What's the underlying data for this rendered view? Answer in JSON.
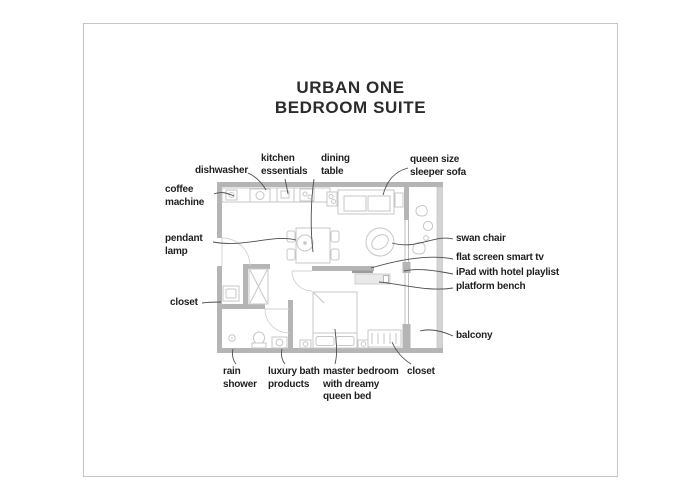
{
  "title": {
    "text": "URBAN ONE\nBEDROOM SUITE"
  },
  "labels": [
    {
      "id": "coffee-machine",
      "text": "coffee\nmachine"
    },
    {
      "id": "dishwasher",
      "text": "dishwasher"
    },
    {
      "id": "kitchen-essentials",
      "text": "kitchen\nessentials"
    },
    {
      "id": "dining-table",
      "text": "dining\ntable"
    },
    {
      "id": "queen-sleeper-sofa",
      "text": "queen size\nsleeper sofa"
    },
    {
      "id": "pendant-lamp",
      "text": "pendant\nlamp"
    },
    {
      "id": "swan-chair",
      "text": "swan chair"
    },
    {
      "id": "flat-screen-smart-tv",
      "text": "flat screen smart tv"
    },
    {
      "id": "ipad-hotel-playlist",
      "text": "iPad with hotel playlist"
    },
    {
      "id": "platform-bench",
      "text": "platform bench"
    },
    {
      "id": "closet-left",
      "text": "closet"
    },
    {
      "id": "balcony",
      "text": "balcony"
    },
    {
      "id": "rain-shower",
      "text": "rain\nshower"
    },
    {
      "id": "luxury-bath-products",
      "text": "luxury bath\nproducts"
    },
    {
      "id": "master-bedroom",
      "text": "master bedroom\nwith dreamy\nqueen bed"
    },
    {
      "id": "closet-bottom",
      "text": "closet"
    }
  ],
  "colors": {
    "wall": "#b5b5b5",
    "railing": "#d4d4d4",
    "furniture_outline": "#c7c7c7",
    "leader_line": "#4d4d4d",
    "text": "#1f1f1f",
    "card_border": "#c5c5c5"
  }
}
